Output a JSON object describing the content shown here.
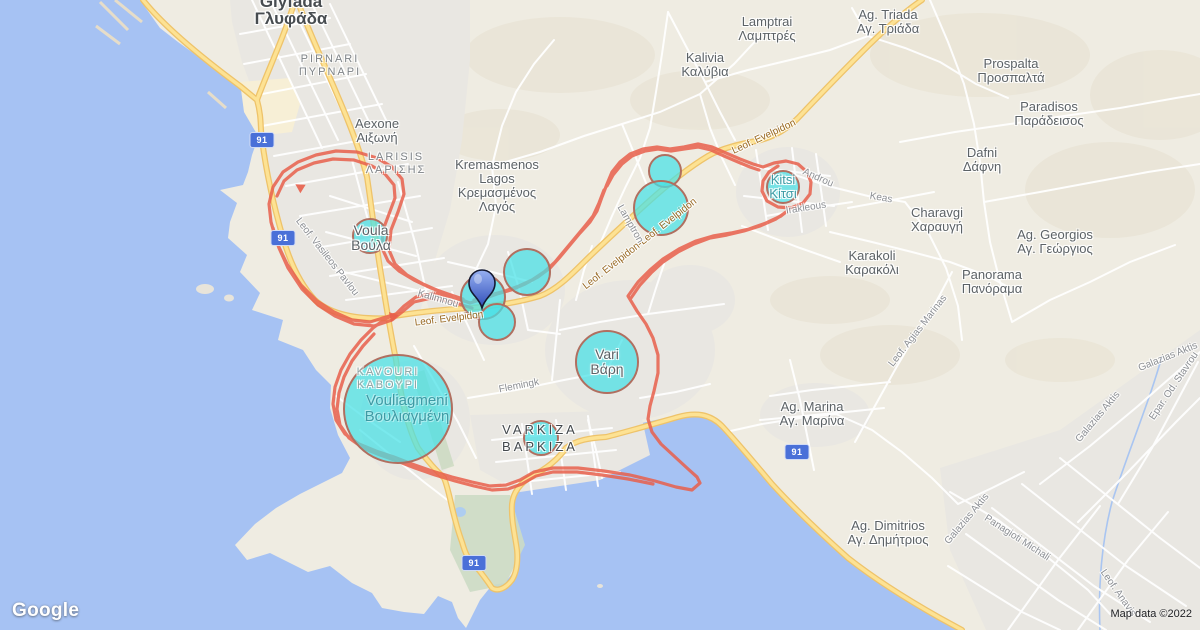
{
  "map": {
    "provider_logo": "Google",
    "attribution": "Map data ©2022",
    "highway_shield": "91",
    "colors": {
      "water": "#a6c2f3",
      "land": "#efece2",
      "urban": "#e9e7e2",
      "highway_fill": "#fde293",
      "highway_casing": "#eec36a",
      "route": "#e8604c",
      "bubble_fill": "#45e0e6",
      "bubble_stroke": "#b06f60",
      "shield_bg": "#4a70d8",
      "pin_blue": "#3a57c0"
    }
  },
  "places": {
    "glyfada": {
      "en": "Glyfada",
      "el": "Γλυφάδα"
    },
    "aexone": {
      "en": "Aexone",
      "el": "Αιξωνή"
    },
    "kremasmenos": {
      "en1": "Kremasmenos",
      "en2": "Lagos",
      "el1": "Κρεμασμένος",
      "el2": "Λαγός"
    },
    "voula": {
      "en": "Voula",
      "el": "Βούλα"
    },
    "lamptrai": {
      "en": "Lamptrai",
      "el": "Λαμπτρές"
    },
    "ag_triada": {
      "en": "Ag. Triada",
      "el": "Αγ. Τριάδα"
    },
    "kalivia": {
      "en": "Kalivia",
      "el": "Καλύβια"
    },
    "prospalta": {
      "en": "Prospalta",
      "el": "Προσπαλτά"
    },
    "paradisos": {
      "en": "Paradisos",
      "el": "Παράδεισος"
    },
    "dafni": {
      "en": "Dafni",
      "el": "Δάφνη"
    },
    "charavgi": {
      "en": "Charavgi",
      "el": "Χαραυγή"
    },
    "karakoli": {
      "en": "Karakoli",
      "el": "Καρακόλι"
    },
    "ag_georgios": {
      "en": "Ag. Georgios",
      "el": "Αγ. Γεώργιος"
    },
    "panorama": {
      "en": "Panorama",
      "el": "Πανόραμα"
    },
    "ag_marina": {
      "en": "Ag. Marina",
      "el": "Αγ. Μαρίνα"
    },
    "ag_dimitrios": {
      "en": "Ag. Dimitrios",
      "el": "Αγ. Δημήτριος"
    },
    "kitsi": {
      "en": "Kitsi",
      "el": "Κίτσι"
    },
    "vari": {
      "en": "Vari",
      "el": "Βάρη"
    },
    "vouliagmeni": {
      "en": "Vouliagmeni",
      "el": "Βουλιαγμένη"
    }
  },
  "districts": {
    "pirnari": {
      "en": "PIRNARI",
      "el": "ΠΥΡΝΑΡΙ"
    },
    "larisis": {
      "en": "LARISIS",
      "el": "ΛΑΡΙΣΗΣ"
    },
    "kavouri": {
      "en": "KAVOURI",
      "el": "ΚΑΒΟΥΡΙ"
    },
    "varkiza": {
      "en": "VARKIZA",
      "el": "ΒΑΡΚΙΖΑ"
    }
  },
  "road_labels": [
    "Leof. Vasileos Pavlou",
    "Kalimnou",
    "Leof. Evelpidon",
    "Leof. Evelpidon-Leof. Evelpidon",
    "Leof. Evelpidon",
    "Lamptron",
    "Androu",
    "Keas",
    "Irakleous",
    "Flemingk",
    "Leof. Agias Marinas",
    "Galazias Aktis",
    "Epar. Od. Stavrou",
    "Galazias Aktis",
    "Galazias Aktis",
    "Panagioti Michali",
    "Leof. Anavis"
  ]
}
